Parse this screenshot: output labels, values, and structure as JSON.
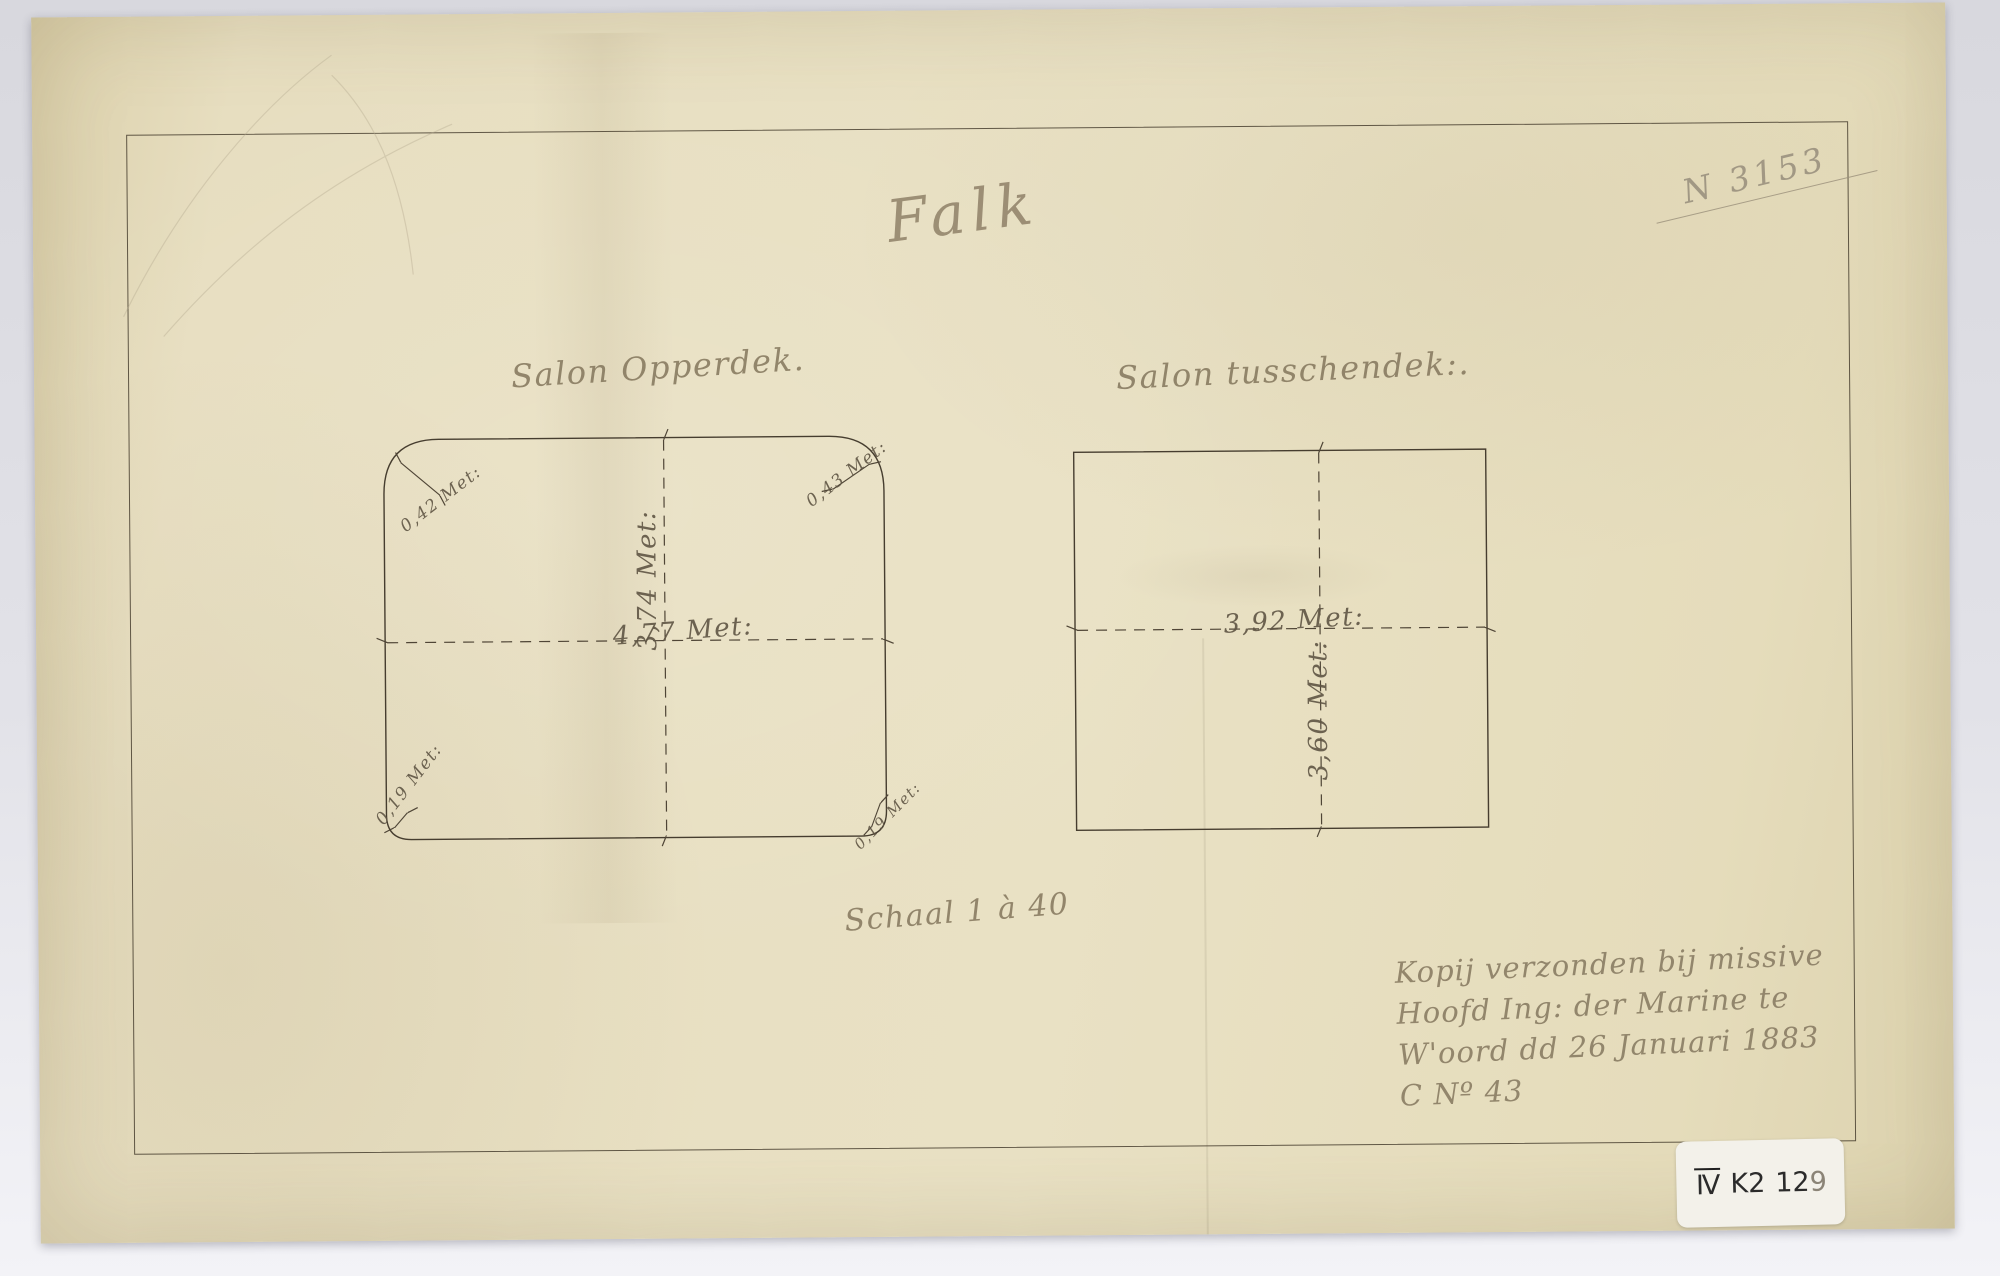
{
  "doc": {
    "title": "Falk",
    "reg_no": "N 3153",
    "scale": "Schaal 1 à 40",
    "note": {
      "l1": "Kopij verzonden bij missive",
      "l2": "Hoofd Ing: der Marine te",
      "l3": "W'oord dd 26 Januari 1883",
      "l4": "C Nº 43"
    },
    "tag": {
      "roman": "IV",
      "code": "K2",
      "num": "12",
      "num_tail": "9"
    },
    "left": {
      "label": "Salon Opperdek.",
      "width": "4,77 Met:",
      "height": "3,74 Met:",
      "c_tl": "0,42 Met:",
      "c_tr": "0,43 Met:",
      "c_bl": "0,19 Met:",
      "c_br": "0,19 Met:"
    },
    "right": {
      "label": "Salon tusschendek:.",
      "width": "3,92 Met:",
      "height": "3,60 Met:"
    },
    "colors": {
      "paper": "#e7dec0",
      "ink": "#463d2f",
      "handwriting": "#83765c",
      "pencil": "#9b927f",
      "background": "#e2e2e8",
      "tag_background": "#f3f1ea"
    }
  }
}
